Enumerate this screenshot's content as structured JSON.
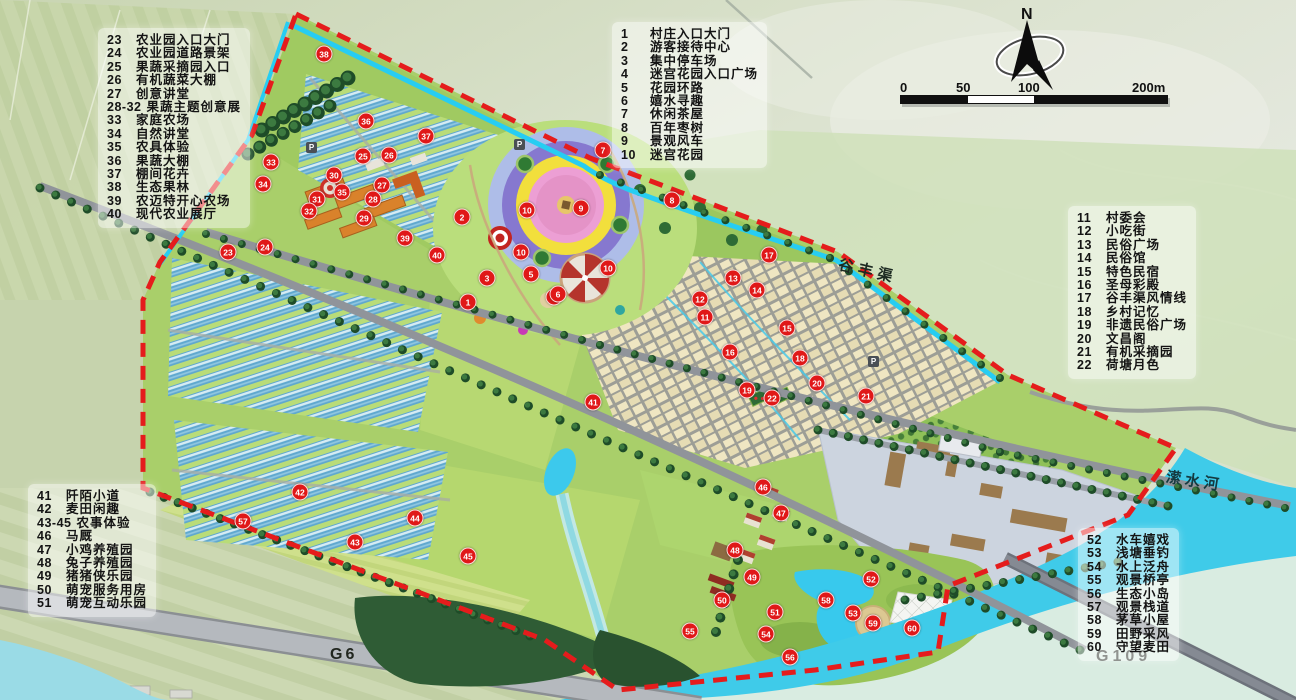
{
  "legends": {
    "legend_agri": {
      "position": "top-left",
      "items": [
        {
          "num": "23",
          "label": "农业园入口大门"
        },
        {
          "num": "24",
          "label": "农业园道路景架"
        },
        {
          "num": "25",
          "label": "果蔬采摘园入口"
        },
        {
          "num": "26",
          "label": "有机蔬菜大棚"
        },
        {
          "num": "27",
          "label": "创意讲堂"
        },
        {
          "num": "28-32",
          "label": "果蔬主题创意展"
        },
        {
          "num": "33",
          "label": "家庭农场"
        },
        {
          "num": "34",
          "label": "自然讲堂"
        },
        {
          "num": "35",
          "label": "农具体验"
        },
        {
          "num": "36",
          "label": "果蔬大棚"
        },
        {
          "num": "37",
          "label": "棚间花卉"
        },
        {
          "num": "38",
          "label": "生态果林"
        },
        {
          "num": "39",
          "label": "农迈特开心农场"
        },
        {
          "num": "40",
          "label": "现代农业展厅"
        }
      ]
    },
    "legend_entry": {
      "position": "top-center",
      "items": [
        {
          "num": "1",
          "label": "村庄入口大门"
        },
        {
          "num": "2",
          "label": "游客接待中心"
        },
        {
          "num": "3",
          "label": "集中停车场"
        },
        {
          "num": "4",
          "label": "迷宫花园入口广场"
        },
        {
          "num": "5",
          "label": "花园环路"
        },
        {
          "num": "6",
          "label": "嬉水寻趣"
        },
        {
          "num": "7",
          "label": "休闲茶屋"
        },
        {
          "num": "8",
          "label": "百年枣树"
        },
        {
          "num": "9",
          "label": "景观风车"
        },
        {
          "num": "10",
          "label": "迷宫花园"
        }
      ]
    },
    "legend_folk": {
      "position": "right",
      "items": [
        {
          "num": "11",
          "label": "村委会"
        },
        {
          "num": "12",
          "label": "小吃街"
        },
        {
          "num": "13",
          "label": "民俗广场"
        },
        {
          "num": "14",
          "label": "民俗馆"
        },
        {
          "num": "15",
          "label": "特色民宿"
        },
        {
          "num": "16",
          "label": "圣母彩殿"
        },
        {
          "num": "17",
          "label": "谷丰渠风情线"
        },
        {
          "num": "18",
          "label": "乡村记忆"
        },
        {
          "num": "19",
          "label": "非遗民俗广场"
        },
        {
          "num": "20",
          "label": "文昌阁"
        },
        {
          "num": "21",
          "label": "有机采摘园"
        },
        {
          "num": "22",
          "label": "荷塘月色"
        }
      ]
    },
    "legend_farm": {
      "position": "bottom-left",
      "items": [
        {
          "num": "41",
          "label": "阡陌小道"
        },
        {
          "num": "42",
          "label": "麦田闲趣"
        },
        {
          "num": "43-45",
          "label": "农事体验"
        },
        {
          "num": "46",
          "label": "马厩"
        },
        {
          "num": "47",
          "label": "小鸡养殖园"
        },
        {
          "num": "48",
          "label": "兔子养殖园"
        },
        {
          "num": "49",
          "label": "猪猪侠乐园"
        },
        {
          "num": "50",
          "label": "萌宠服务用房"
        },
        {
          "num": "51",
          "label": "萌宠互动乐园"
        }
      ]
    },
    "legend_water": {
      "position": "bottom-right",
      "items": [
        {
          "num": "52",
          "label": "水车嬉戏"
        },
        {
          "num": "53",
          "label": "浅塘垂钓"
        },
        {
          "num": "54",
          "label": "水上泛舟"
        },
        {
          "num": "55",
          "label": "观景桥亭"
        },
        {
          "num": "56",
          "label": "生态小岛"
        },
        {
          "num": "57",
          "label": "观景栈道"
        },
        {
          "num": "58",
          "label": "茅草小屋"
        },
        {
          "num": "59",
          "label": "田野采风"
        },
        {
          "num": "60",
          "label": "守望麦田"
        }
      ]
    }
  },
  "map_labels": {
    "canal": "谷丰渠",
    "river": "潆水河",
    "highway_g6": "G6",
    "highway_g109": "G109",
    "parking": "P"
  },
  "compass": {
    "north_label": "N"
  },
  "scale_bar": {
    "labels": [
      "0",
      "50",
      "100",
      "200m"
    ]
  },
  "colors": {
    "boundary_red": "#e51c1c",
    "canal_cyan": "#27cdf2",
    "river_cyan": "#3fcbe9",
    "marker_red": "#e01818",
    "legend_text": "#141414"
  },
  "markers": [
    {
      "n": "1",
      "x": 468,
      "y": 302
    },
    {
      "n": "2",
      "x": 462,
      "y": 217
    },
    {
      "n": "3",
      "x": 487,
      "y": 278
    },
    {
      "n": "4",
      "x": 554,
      "y": 297
    },
    {
      "n": "5",
      "x": 531,
      "y": 274
    },
    {
      "n": "6",
      "x": 558,
      "y": 294
    },
    {
      "n": "7",
      "x": 603,
      "y": 150
    },
    {
      "n": "8",
      "x": 672,
      "y": 200
    },
    {
      "n": "9",
      "x": 581,
      "y": 208
    },
    {
      "n": "10",
      "x": 527,
      "y": 210
    },
    {
      "n": "10",
      "x": 521,
      "y": 252
    },
    {
      "n": "10",
      "x": 608,
      "y": 268
    },
    {
      "n": "11",
      "x": 705,
      "y": 317
    },
    {
      "n": "12",
      "x": 700,
      "y": 299
    },
    {
      "n": "13",
      "x": 733,
      "y": 278
    },
    {
      "n": "14",
      "x": 757,
      "y": 290
    },
    {
      "n": "15",
      "x": 787,
      "y": 328
    },
    {
      "n": "16",
      "x": 730,
      "y": 352
    },
    {
      "n": "17",
      "x": 769,
      "y": 255
    },
    {
      "n": "18",
      "x": 800,
      "y": 358
    },
    {
      "n": "19",
      "x": 747,
      "y": 390
    },
    {
      "n": "20",
      "x": 817,
      "y": 383
    },
    {
      "n": "21",
      "x": 866,
      "y": 396
    },
    {
      "n": "22",
      "x": 772,
      "y": 398
    },
    {
      "n": "23",
      "x": 228,
      "y": 252
    },
    {
      "n": "24",
      "x": 265,
      "y": 247
    },
    {
      "n": "25",
      "x": 363,
      "y": 156
    },
    {
      "n": "26",
      "x": 389,
      "y": 155
    },
    {
      "n": "27",
      "x": 382,
      "y": 185
    },
    {
      "n": "28",
      "x": 373,
      "y": 199
    },
    {
      "n": "29",
      "x": 364,
      "y": 218
    },
    {
      "n": "30",
      "x": 334,
      "y": 175
    },
    {
      "n": "31",
      "x": 317,
      "y": 199
    },
    {
      "n": "32",
      "x": 309,
      "y": 211
    },
    {
      "n": "33",
      "x": 271,
      "y": 162
    },
    {
      "n": "34",
      "x": 263,
      "y": 184
    },
    {
      "n": "35",
      "x": 342,
      "y": 192
    },
    {
      "n": "36",
      "x": 366,
      "y": 121
    },
    {
      "n": "37",
      "x": 426,
      "y": 136
    },
    {
      "n": "38",
      "x": 324,
      "y": 54
    },
    {
      "n": "39",
      "x": 405,
      "y": 238
    },
    {
      "n": "40",
      "x": 437,
      "y": 255
    },
    {
      "n": "41",
      "x": 593,
      "y": 402
    },
    {
      "n": "42",
      "x": 300,
      "y": 492
    },
    {
      "n": "43",
      "x": 355,
      "y": 542
    },
    {
      "n": "44",
      "x": 415,
      "y": 518
    },
    {
      "n": "45",
      "x": 468,
      "y": 556
    },
    {
      "n": "46",
      "x": 763,
      "y": 487
    },
    {
      "n": "47",
      "x": 781,
      "y": 513
    },
    {
      "n": "48",
      "x": 735,
      "y": 550
    },
    {
      "n": "49",
      "x": 752,
      "y": 577
    },
    {
      "n": "50",
      "x": 722,
      "y": 600
    },
    {
      "n": "51",
      "x": 775,
      "y": 612
    },
    {
      "n": "52",
      "x": 871,
      "y": 579
    },
    {
      "n": "53",
      "x": 853,
      "y": 613
    },
    {
      "n": "54",
      "x": 766,
      "y": 634
    },
    {
      "n": "55",
      "x": 690,
      "y": 631
    },
    {
      "n": "56",
      "x": 790,
      "y": 657
    },
    {
      "n": "57",
      "x": 243,
      "y": 521
    },
    {
      "n": "58",
      "x": 826,
      "y": 600
    },
    {
      "n": "59",
      "x": 873,
      "y": 623
    },
    {
      "n": "60",
      "x": 912,
      "y": 628
    }
  ]
}
